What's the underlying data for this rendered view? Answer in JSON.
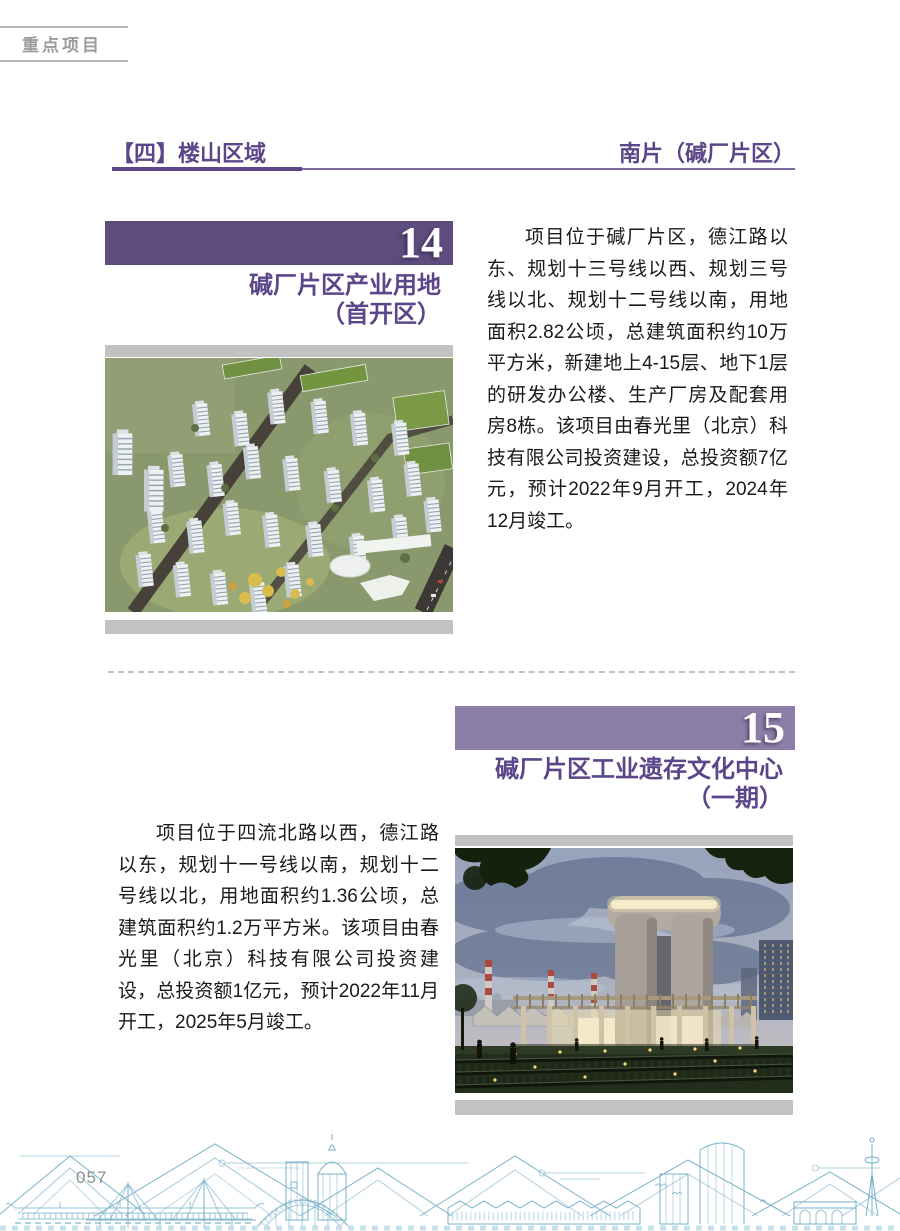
{
  "page": {
    "tag": "重点项目"
  },
  "section": {
    "title": "【四】楼山区域",
    "subtitle": "南片（碱厂片区）"
  },
  "projects": [
    {
      "number": "14",
      "title_line1": "碱厂片区产业用地",
      "title_line2": "（首开区）",
      "description": "项目位于碱厂片区，德江路以东、规划十三号线以西、规划三号线以北、规划十二号线以南，用地面积2.82公顷，总建筑面积约10万平方米，新建地上4-15层、地下1层的研发办公楼、生产厂房及配套用房8栋。该项目由春光里（北京）科技有限公司投资建设，总投资额7亿元，预计2022年9月开工，2024年12月竣工。"
    },
    {
      "number": "15",
      "title_line1": "碱厂片区工业遗存文化中心",
      "title_line2": "（一期）",
      "description": "项目位于四流北路以西，德江路以东，规划十一号线以南，规划十二号线以北，用地面积约1.36公顷，总建筑面积约1.2万平方米。该项目由春光里（北京）科技有限公司投资建设，总投资额1亿元，预计2022年11月开工，2025年5月竣工。"
    }
  ],
  "footer": {
    "page_number": "057"
  },
  "colors": {
    "accent": "#5b4689",
    "bar14": "#5d4c7d",
    "bar15": "#8b7ea7",
    "graybar": "#c2c2c2",
    "skyline": "#6fa8c4"
  }
}
